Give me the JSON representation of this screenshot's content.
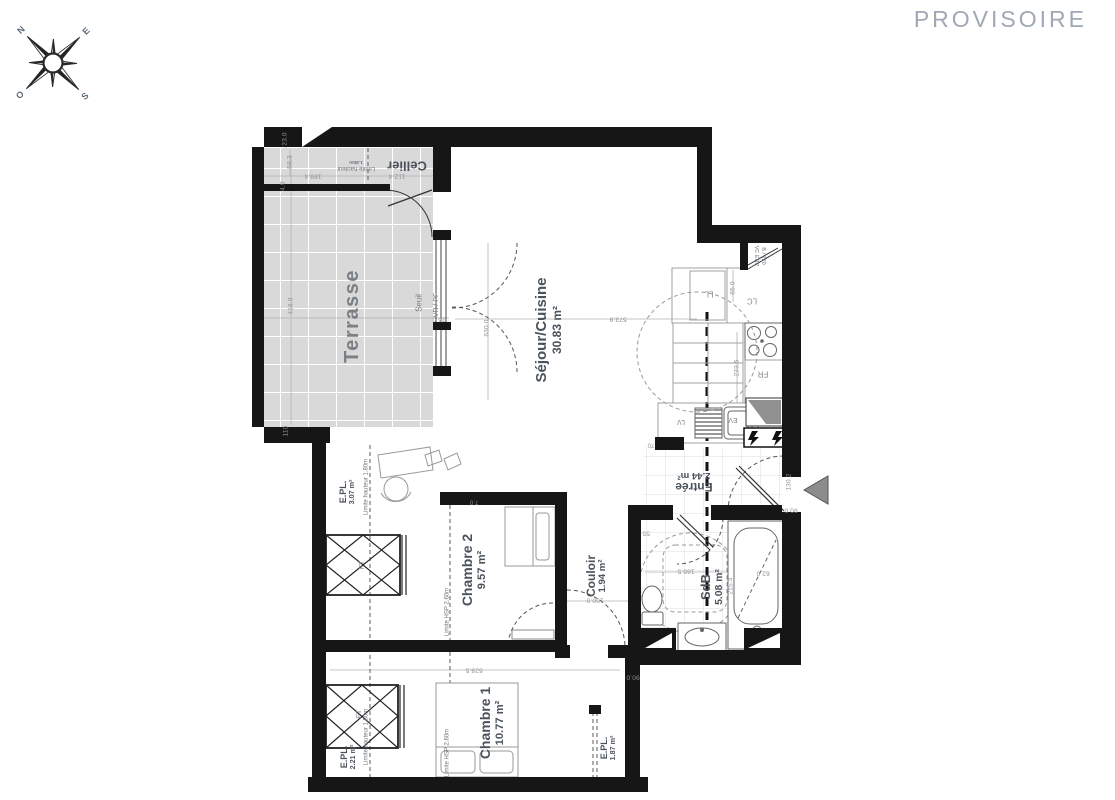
{
  "watermark": "PROVISOIRE",
  "compass": {
    "n": "N",
    "e": "E",
    "s": "S",
    "o": "O"
  },
  "colors": {
    "wall": "#161616",
    "tile": "#d9d9d9",
    "watermark": "#9fa8b4",
    "label": "#4a525c",
    "arrow": "#8c8c8c"
  },
  "icons": {
    "compass_rose": "eight-point-star",
    "entrance_arrow": "left-pointing-triangle",
    "electrical_panel": "lightning-bolt",
    "roof_window": "crossed-diamond-box"
  },
  "rooms_summary": [
    {
      "name": "Séjour/Cuisine",
      "area_m2": "30.83"
    },
    {
      "name": "Chambre 1",
      "area_m2": "10.77"
    },
    {
      "name": "Chambre 2",
      "area_m2": "9.57"
    },
    {
      "name": "SdB",
      "area_m2": "5.08"
    },
    {
      "name": "Entrée",
      "area_m2": "2.44"
    },
    {
      "name": "Couloir",
      "area_m2": "1.94"
    },
    {
      "name": "E.PL.",
      "area_m2": "3.07"
    },
    {
      "name": "E.PL.",
      "area_m2": "2.21"
    },
    {
      "name": "E.PL.",
      "area_m2": "1.87"
    },
    {
      "name": "Cellier",
      "area_m2": ""
    },
    {
      "name": "Terrasse",
      "area_m2": ""
    }
  ],
  "labels": [
    {
      "t": "Cellier",
      "x": 407,
      "y": 165,
      "rot": 180,
      "size": 13,
      "cls": "room",
      "dn": "room-label-cellier"
    },
    {
      "t": "Terrasse",
      "x": 352,
      "y": 316,
      "rot": -90,
      "size": 20,
      "cls": "room room-terrasse",
      "dn": "room-label-terrasse"
    },
    {
      "t": "Séjour/Cuisine",
      "a": "30.83 m²",
      "x": 549,
      "y": 330,
      "rot": -90,
      "size": 15,
      "cls": "room",
      "dn": "room-label-sejour-cuisine"
    },
    {
      "t": "Entrée",
      "a": "2.44 m²",
      "x": 694,
      "y": 481,
      "rot": 180,
      "size": 12,
      "cls": "room",
      "dn": "room-label-entree"
    },
    {
      "t": "SdB",
      "a": "5.08 m²",
      "x": 712,
      "y": 587,
      "rot": -90,
      "size": 13,
      "cls": "room",
      "dn": "room-label-sdb"
    },
    {
      "t": "Couloir",
      "a": "1.94 m²",
      "x": 597,
      "y": 576,
      "rot": -90,
      "size": 12,
      "cls": "room",
      "dn": "room-label-couloir"
    },
    {
      "t": "Chambre 2",
      "a": "9.57 m²",
      "x": 474,
      "y": 570,
      "rot": -90,
      "size": 14,
      "cls": "room",
      "dn": "room-label-chambre-2"
    },
    {
      "t": "Chambre 1",
      "a": "10.77 m²",
      "x": 492,
      "y": 723,
      "rot": -90,
      "size": 14,
      "cls": "room",
      "dn": "room-label-chambre-1"
    },
    {
      "t": "E.PL.",
      "a": "3.07 m²",
      "x": 347,
      "y": 492,
      "rot": -90,
      "size": 9,
      "cls": "room",
      "dn": "room-label-epl-1"
    },
    {
      "t": "E.PL.",
      "a": "2.21 m²",
      "x": 348,
      "y": 757,
      "rot": -90,
      "size": 9,
      "cls": "room",
      "dn": "room-label-epl-2"
    },
    {
      "t": "E.PL.",
      "a": "1.87 m²",
      "x": 608,
      "y": 748,
      "rot": -90,
      "size": 9,
      "cls": "room",
      "dn": "room-label-epl-3"
    },
    {
      "t": "Seuil",
      "x": 420,
      "y": 303,
      "rot": -90,
      "size": 8,
      "cls": "ann",
      "dn": "annotation-seuil"
    },
    {
      "t": "VR / PF",
      "x": 437,
      "y": 305,
      "rot": -90,
      "size": 7,
      "cls": "ann",
      "dn": "annotation-vr-pf"
    },
    {
      "t": "VC ERP",
      "x": 756,
      "y": 256,
      "rot": 90,
      "size": 5.5,
      "cls": "ann",
      "dn": "annotation-vc-erp"
    },
    {
      "t": "B / 120",
      "x": 763,
      "y": 256,
      "rot": 90,
      "size": 5.5,
      "cls": "ann",
      "dn": "annotation-b-120"
    },
    {
      "t": "Limite hauteur",
      "a": "1.80m",
      "x": 356,
      "y": 165,
      "rot": 180,
      "size": 6,
      "cls": "ann",
      "dn": "annotation-limite-hauteur-cellier"
    },
    {
      "t": "Limite hauteur 1.80m",
      "x": 367,
      "y": 487,
      "rot": -90,
      "size": 6,
      "cls": "ann",
      "dn": "annotation-limite-hauteur-ch2"
    },
    {
      "t": "Limite hauteur 1.80m",
      "x": 367,
      "y": 737,
      "rot": -90,
      "size": 6,
      "cls": "ann",
      "dn": "annotation-limite-hauteur-ch1"
    },
    {
      "t": "Limite HSP 2.60m",
      "x": 448,
      "y": 612,
      "rot": -90,
      "size": 6,
      "cls": "ann",
      "dn": "annotation-limite-hsp-ch2"
    },
    {
      "t": "Limite HSP 2.60m",
      "x": 448,
      "y": 753,
      "rot": -90,
      "size": 6,
      "cls": "ann",
      "dn": "annotation-limite-hsp-ch1"
    },
    {
      "t": "LL",
      "x": 709,
      "y": 293,
      "rot": 180,
      "size": 8,
      "cls": "code",
      "dn": "appliance-label-ll"
    },
    {
      "t": "LC",
      "x": 752,
      "y": 300,
      "rot": 180,
      "size": 8,
      "cls": "code",
      "dn": "appliance-label-lc"
    },
    {
      "t": "FR",
      "x": 763,
      "y": 373,
      "rot": 180,
      "size": 8,
      "cls": "code",
      "dn": "appliance-label-fr"
    },
    {
      "t": "LV",
      "x": 681,
      "y": 421,
      "rot": 180,
      "size": 7,
      "cls": "code",
      "dn": "appliance-label-lv"
    },
    {
      "t": "EV",
      "x": 733,
      "y": 419,
      "rot": 180,
      "size": 7,
      "cls": "code",
      "dn": "appliance-label-ev"
    },
    {
      "t": "FT",
      "x": 363,
      "y": 565,
      "rot": -90,
      "size": 7,
      "cls": "code",
      "dn": "roof-window-label-1"
    },
    {
      "t": "FT",
      "x": 360,
      "y": 714,
      "rot": -90,
      "size": 7,
      "cls": "code",
      "dn": "roof-window-label-2"
    },
    {
      "t": "23.0",
      "x": 285,
      "y": 139,
      "rot": -90,
      "size": 6.5,
      "cls": "dim"
    },
    {
      "t": "58.3",
      "x": 290,
      "y": 162,
      "rot": -90,
      "size": 6.5,
      "cls": "dim"
    },
    {
      "t": "4.9",
      "x": 283,
      "y": 186,
      "rot": -90,
      "size": 6.5,
      "cls": "dim"
    },
    {
      "t": "189.4",
      "x": 313,
      "y": 176,
      "rot": 180,
      "size": 6.5,
      "cls": "dim"
    },
    {
      "t": "112.4",
      "x": 397,
      "y": 176,
      "rot": 180,
      "size": 6.5,
      "cls": "dim"
    },
    {
      "t": "418.0",
      "x": 291,
      "y": 306,
      "rot": -90,
      "size": 6.5,
      "cls": "dim"
    },
    {
      "t": "110",
      "x": 286,
      "y": 431,
      "rot": -90,
      "size": 6.5,
      "cls": "dim"
    },
    {
      "t": "36.0",
      "x": 439,
      "y": 319,
      "rot": 180,
      "size": 6.5,
      "cls": "dim"
    },
    {
      "t": "630.0",
      "x": 487,
      "y": 328,
      "rot": -90,
      "size": 6.5,
      "cls": "dim"
    },
    {
      "t": "573.9",
      "x": 618,
      "y": 319,
      "rot": 180,
      "size": 6.5,
      "cls": "dim"
    },
    {
      "t": "65.0",
      "x": 733,
      "y": 288,
      "rot": -90,
      "size": 6.5,
      "cls": "dim"
    },
    {
      "t": "233.5",
      "x": 737,
      "y": 368,
      "rot": -90,
      "size": 6.5,
      "cls": "dim"
    },
    {
      "t": "70",
      "x": 651,
      "y": 444,
      "rot": 180,
      "size": 6,
      "cls": "dim"
    },
    {
      "t": "7.0",
      "x": 474,
      "y": 501,
      "rot": 180,
      "size": 6,
      "cls": "dim"
    },
    {
      "t": "130.2",
      "x": 789,
      "y": 482,
      "rot": -90,
      "size": 6.5,
      "cls": "dim"
    },
    {
      "t": "90.0",
      "x": 791,
      "y": 510,
      "rot": 180,
      "size": 6.5,
      "cls": "dim"
    },
    {
      "t": "100.0",
      "x": 595,
      "y": 600,
      "rot": 180,
      "size": 6.5,
      "cls": "dim"
    },
    {
      "t": "55",
      "x": 646,
      "y": 533,
      "rot": 180,
      "size": 6.5,
      "cls": "dim"
    },
    {
      "t": "186.5",
      "x": 686,
      "y": 571,
      "rot": 180,
      "size": 6.5,
      "cls": "dim"
    },
    {
      "t": "62.0",
      "x": 763,
      "y": 573,
      "rot": 180,
      "size": 6.5,
      "cls": "dim"
    },
    {
      "t": "215.4",
      "x": 731,
      "y": 586,
      "rot": -90,
      "size": 6.5,
      "cls": "dim"
    },
    {
      "t": "528.5",
      "x": 474,
      "y": 670,
      "rot": 180,
      "size": 6.5,
      "cls": "dim"
    },
    {
      "t": "90.0",
      "x": 633,
      "y": 677,
      "rot": 180,
      "size": 6.5,
      "cls": "dim"
    }
  ]
}
